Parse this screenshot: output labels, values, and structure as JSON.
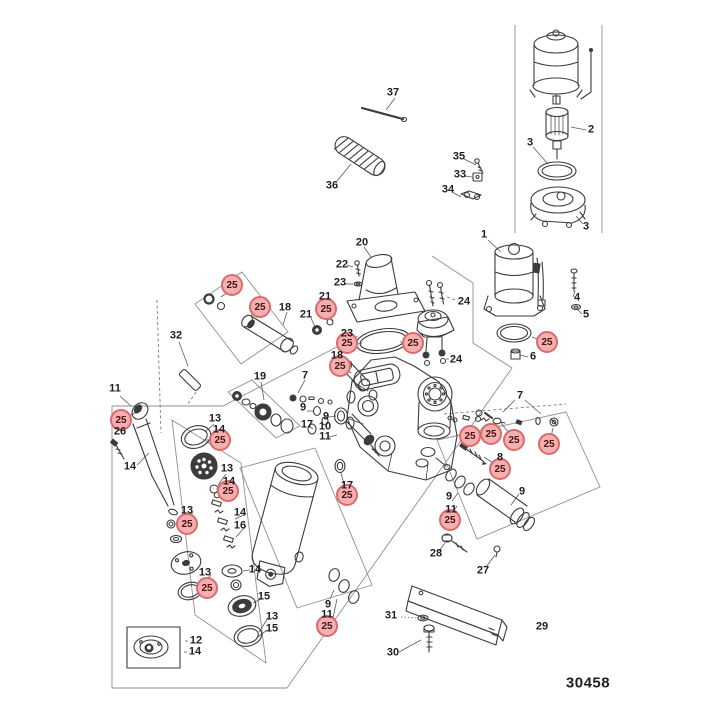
{
  "diagram": {
    "drawing_number": "30458",
    "highlight_value": "25",
    "colors": {
      "background": "#ffffff",
      "line": "#3c3c3c",
      "bracket_line": "#8f8f8f",
      "label_text": "#1f1f1f",
      "highlight_fill": "#f3b0b0",
      "highlight_stroke": "#dd6a6a",
      "highlight_text": "#4d1111"
    },
    "part_labels": [
      {
        "t": "37",
        "x": 393,
        "y": 93
      },
      {
        "t": "36",
        "x": 332,
        "y": 186
      },
      {
        "t": "2",
        "x": 591,
        "y": 130
      },
      {
        "t": "3",
        "x": 530,
        "y": 143
      },
      {
        "t": "3",
        "x": 586,
        "y": 227
      },
      {
        "t": "35",
        "x": 459,
        "y": 157
      },
      {
        "t": "33",
        "x": 460,
        "y": 175
      },
      {
        "t": "34",
        "x": 448,
        "y": 190
      },
      {
        "t": "1",
        "x": 484,
        "y": 235
      },
      {
        "t": "4",
        "x": 577,
        "y": 298
      },
      {
        "t": "5",
        "x": 586,
        "y": 315
      },
      {
        "t": "20",
        "x": 362,
        "y": 243
      },
      {
        "t": "22",
        "x": 342,
        "y": 265
      },
      {
        "t": "23",
        "x": 340,
        "y": 283
      },
      {
        "t": "21",
        "x": 325,
        "y": 297
      },
      {
        "t": "21",
        "x": 306,
        "y": 315
      },
      {
        "t": "18",
        "x": 285,
        "y": 308
      },
      {
        "t": "23",
        "x": 347,
        "y": 334
      },
      {
        "t": "24",
        "x": 464,
        "y": 302
      },
      {
        "t": "24",
        "x": 456,
        "y": 360
      },
      {
        "t": "6",
        "x": 533,
        "y": 357
      },
      {
        "t": "18",
        "x": 337,
        "y": 356
      },
      {
        "t": "7",
        "x": 305,
        "y": 376
      },
      {
        "t": "19",
        "x": 260,
        "y": 377
      },
      {
        "t": "32",
        "x": 176,
        "y": 336
      },
      {
        "t": "11",
        "x": 115,
        "y": 389
      },
      {
        "t": "26",
        "x": 120,
        "y": 432
      },
      {
        "t": "14",
        "x": 130,
        "y": 467
      },
      {
        "t": "13",
        "x": 215,
        "y": 419
      },
      {
        "t": "14",
        "x": 219,
        "y": 430
      },
      {
        "t": "13",
        "x": 227,
        "y": 469
      },
      {
        "t": "14",
        "x": 229,
        "y": 482
      },
      {
        "t": "13",
        "x": 187,
        "y": 511
      },
      {
        "t": "14",
        "x": 255,
        "y": 570
      },
      {
        "t": "14",
        "x": 240,
        "y": 513
      },
      {
        "t": "16",
        "x": 240,
        "y": 526
      },
      {
        "t": "13",
        "x": 205,
        "y": 573
      },
      {
        "t": "15",
        "x": 264,
        "y": 597
      },
      {
        "t": "13",
        "x": 272,
        "y": 617
      },
      {
        "t": "15",
        "x": 272,
        "y": 629
      },
      {
        "t": "12",
        "x": 196,
        "y": 641
      },
      {
        "t": "14",
        "x": 195,
        "y": 652
      },
      {
        "t": "9",
        "x": 303,
        "y": 408
      },
      {
        "t": "17",
        "x": 307,
        "y": 425
      },
      {
        "t": "9",
        "x": 326,
        "y": 417
      },
      {
        "t": "10",
        "x": 325,
        "y": 427
      },
      {
        "t": "11",
        "x": 325,
        "y": 437
      },
      {
        "t": "17",
        "x": 347,
        "y": 486
      },
      {
        "t": "9",
        "x": 328,
        "y": 605
      },
      {
        "t": "11",
        "x": 327,
        "y": 615
      },
      {
        "t": "7",
        "x": 520,
        "y": 396
      },
      {
        "t": "8",
        "x": 500,
        "y": 458
      },
      {
        "t": "9",
        "x": 449,
        "y": 497
      },
      {
        "t": "11",
        "x": 451,
        "y": 510
      },
      {
        "t": "9",
        "x": 522,
        "y": 492
      },
      {
        "t": "28",
        "x": 436,
        "y": 554
      },
      {
        "t": "27",
        "x": 483,
        "y": 571
      },
      {
        "t": "31",
        "x": 391,
        "y": 616
      },
      {
        "t": "30",
        "x": 393,
        "y": 653
      },
      {
        "t": "29",
        "x": 542,
        "y": 627
      }
    ],
    "highlight_callouts": [
      {
        "t": "25",
        "x": 232,
        "y": 285
      },
      {
        "t": "25",
        "x": 260,
        "y": 307
      },
      {
        "t": "25",
        "x": 326,
        "y": 309
      },
      {
        "t": "25",
        "x": 347,
        "y": 343
      },
      {
        "t": "25",
        "x": 413,
        "y": 343
      },
      {
        "t": "25",
        "x": 547,
        "y": 342
      },
      {
        "t": "25",
        "x": 121,
        "y": 420
      },
      {
        "t": "25",
        "x": 220,
        "y": 440
      },
      {
        "t": "25",
        "x": 228,
        "y": 491
      },
      {
        "t": "25",
        "x": 187,
        "y": 524
      },
      {
        "t": "25",
        "x": 207,
        "y": 588
      },
      {
        "t": "25",
        "x": 340,
        "y": 366
      },
      {
        "t": "25",
        "x": 347,
        "y": 495
      },
      {
        "t": "25",
        "x": 470,
        "y": 436
      },
      {
        "t": "25",
        "x": 491,
        "y": 434
      },
      {
        "t": "25",
        "x": 514,
        "y": 440
      },
      {
        "t": "25",
        "x": 549,
        "y": 444
      },
      {
        "t": "25",
        "x": 500,
        "y": 469
      },
      {
        "t": "25",
        "x": 450,
        "y": 520
      },
      {
        "t": "25",
        "x": 327,
        "y": 626
      }
    ]
  }
}
